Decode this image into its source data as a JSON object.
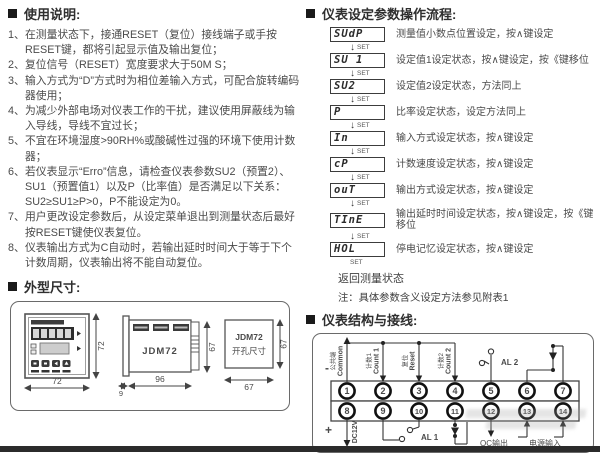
{
  "left": {
    "usage": {
      "title": "使用说明:",
      "items": [
        "在测量状态下，接通RESET（复位）接线端子或手按RESET键，都将引起显示值及输出复位；",
        "复位信号（RESET）宽度要求大于50M S；",
        "输入方式为“D”方式时为相位差输入方式，可配合旋转编码器使用；",
        "为减少外部电场对仪表工作的干扰，建议使用屏蔽线为输入导线，导线不宜过长；",
        "不宜在环境湿度>90RH%或酸碱性过强的环境下使用计数器；",
        "若仪表显示“Erro”信息，请检查仪表参数SU2（预置2）、SU1（预置值1）以及P（比率值）是否满足以下关系：SU2≥SU1≥P>0，P不能设定为0。",
        "用户更改设定参数后，从设定菜单退出到测量状态后最好按RESET键使仪表复位。",
        "仪表输出方式为C自动时，若输出延时时间大于等于下个计数周期，仪表输出将不能自动复位。"
      ]
    },
    "dimensions": {
      "title": "外型尺寸:",
      "front": {
        "width": "72",
        "height": "72"
      },
      "side": {
        "model": "JDM72",
        "length": "96",
        "height": "67",
        "panel": "9"
      },
      "cutout": {
        "model": "JDM72",
        "label": "开孔尺寸",
        "width": "67",
        "height": "67"
      }
    }
  },
  "right": {
    "flow": {
      "title": "仪表设定参数操作流程:",
      "arrow_label": "SET",
      "steps": [
        {
          "display": "SUdP",
          "desc": "测量值小数点位置设定，按∧键设定"
        },
        {
          "display": "SU 1",
          "desc": "设定值1设定状态，按∧键设定，按《键移位"
        },
        {
          "display": "SU2",
          "desc": "设定值2设定状态，方法同上"
        },
        {
          "display": "P",
          "desc": "比率设定状态，设定方法同上"
        },
        {
          "display": "In",
          "desc": "输入方式设定状态，按∧键设定"
        },
        {
          "display": "cP",
          "desc": "计数速度设定状态，按∧键设定"
        },
        {
          "display": "ouT",
          "desc": "输出方式设定状态，按∧键设定"
        },
        {
          "display": "TInE",
          "desc": "输出延时时间设定状态，按∧键设定，按《键移位"
        },
        {
          "display": "HOL",
          "desc": "停电记忆设定状态，按∧键设定"
        }
      ],
      "return_label": "返回测量状态",
      "note": "注：具体参数含义设定方法参见附表1"
    },
    "wiring": {
      "title": "仪表结构与接线:",
      "terminals_top": [
        "1",
        "2",
        "3",
        "4",
        "5",
        "6",
        "7"
      ],
      "terminals_bottom": [
        "8",
        "9",
        "10",
        "11",
        "12",
        "13",
        "14"
      ],
      "labels": {
        "common_cn": "公共端",
        "common_en": "Common",
        "count1_cn": "计数1",
        "count1_en": "Count 1",
        "reset_cn": "复位",
        "reset_en": "Reset",
        "count2_cn": "计数2",
        "count2_en": "Count 2",
        "minus": "-",
        "plus": "+",
        "dc": "DC12V",
        "al1": "AL 1",
        "al2": "AL 2",
        "oc": "OC输出",
        "power": "电源输入"
      },
      "caption": "（具体接线方法以机壳为准）"
    }
  }
}
